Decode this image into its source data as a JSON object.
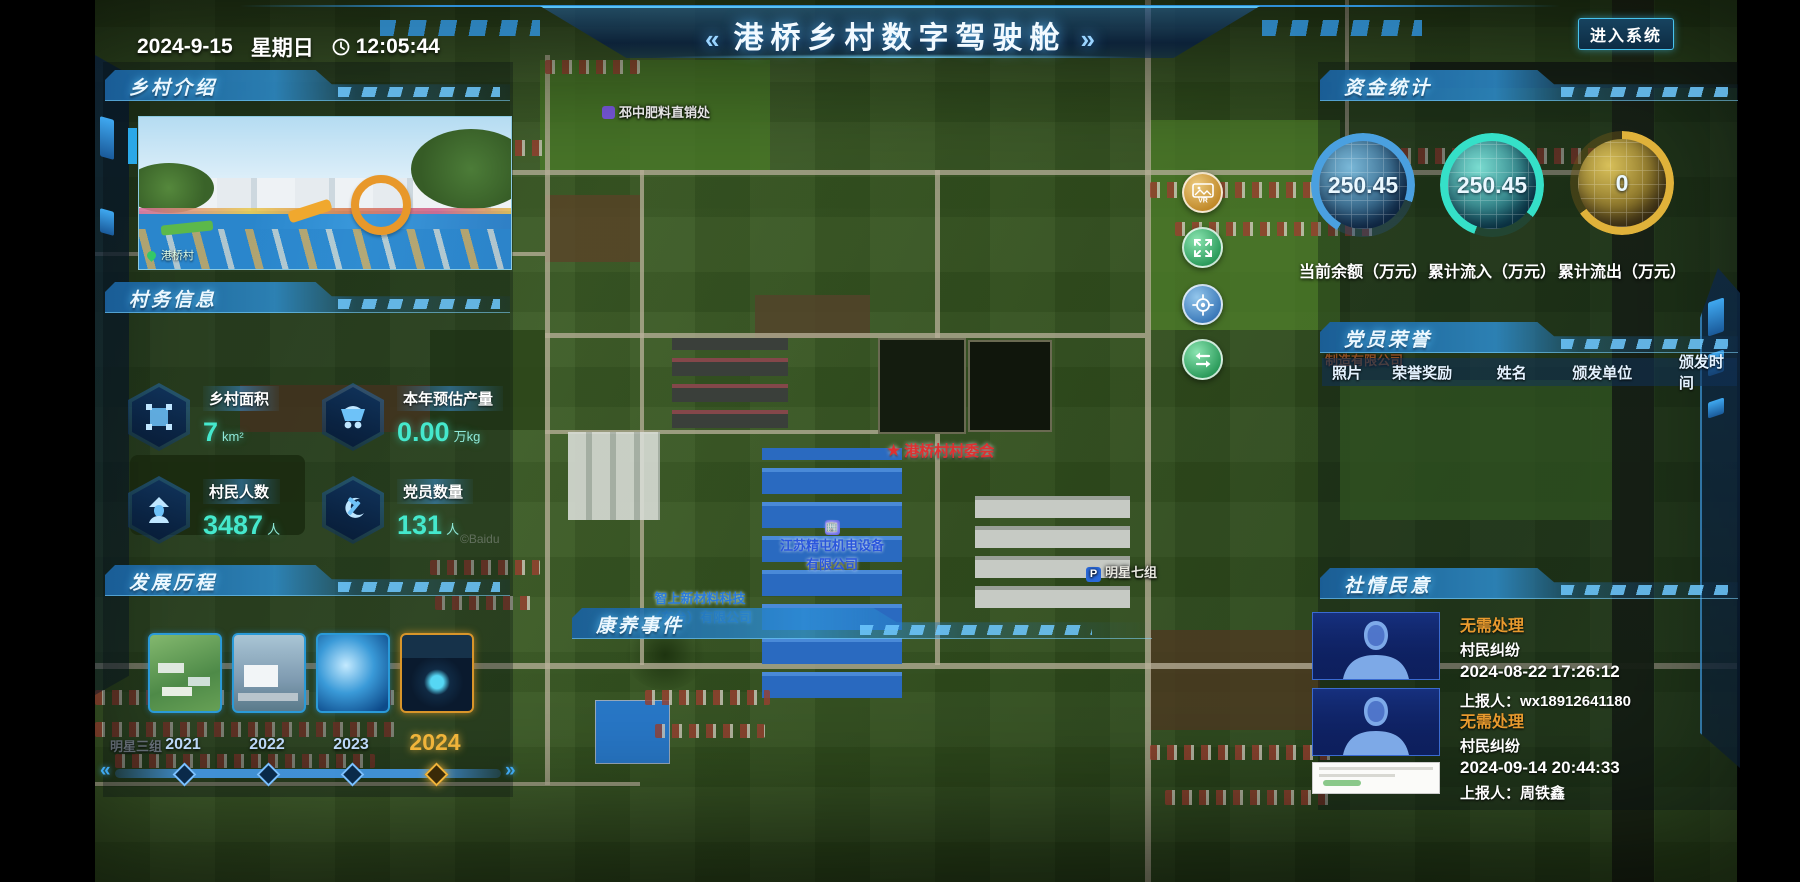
{
  "header": {
    "date": "2024-9-15",
    "weekday": "星期日",
    "time": "12:05:44",
    "title": "港桥乡村数字驾驶舱",
    "title_left_mark": "«",
    "title_right_mark": "»",
    "enter_button": "进入系统"
  },
  "intro": {
    "title": "乡村介绍",
    "photo_caption": "港桥村"
  },
  "village_info": {
    "title": "村务信息",
    "stats": [
      {
        "label": "乡村面积",
        "value": "7",
        "unit": "km²"
      },
      {
        "label": "本年预估产量",
        "value": "0.00",
        "unit": "万kg"
      },
      {
        "label": "村民人数",
        "value": "3487",
        "unit": "人"
      },
      {
        "label": "党员数量",
        "value": "131",
        "unit": "人"
      }
    ]
  },
  "history": {
    "title": "发展历程",
    "years": [
      "2021",
      "2022",
      "2023",
      "2024"
    ],
    "active_year": "2024"
  },
  "funds": {
    "title": "资金统计",
    "gauges": [
      {
        "value": "250.45",
        "label": "当前余额（万元）",
        "color": "#4aa0e0"
      },
      {
        "value": "250.45",
        "label": "累计流入（万元）",
        "color": "#35e0c8"
      },
      {
        "value": "0",
        "label": "累计流出（万元）",
        "color": "#e0b23a"
      }
    ]
  },
  "honors": {
    "title": "党员荣誉",
    "columns": [
      "照片",
      "荣誉奖励",
      "姓名",
      "颁发单位",
      "颁发时间"
    ]
  },
  "sentiment": {
    "title": "社情民意",
    "items": [
      {
        "status": "无需处理",
        "category": "村民纠纷",
        "time": "2024-08-22 17:26:12",
        "reporter": "上报人：wx18912641180"
      },
      {
        "status": "无需处理",
        "category": "村民纠纷",
        "time": "2024-09-14 20:44:33",
        "reporter": "上报人：周铁鑫"
      }
    ]
  },
  "health": {
    "title": "康养事件"
  },
  "map": {
    "poi": [
      {
        "text": "邳中肥料直销处"
      },
      {
        "text": "港桥村村委会"
      },
      {
        "text": "江苏精屯机电设备"
      },
      {
        "text": "有限公司"
      },
      {
        "text": "智上新材料科技"
      },
      {
        "text": "（东台）有限公司"
      },
      {
        "text": "明星七组"
      },
      {
        "text": "明星三组"
      },
      {
        "text": "制造有限公司"
      },
      {
        "text": "©Baidu"
      }
    ],
    "p_marker": "P"
  }
}
